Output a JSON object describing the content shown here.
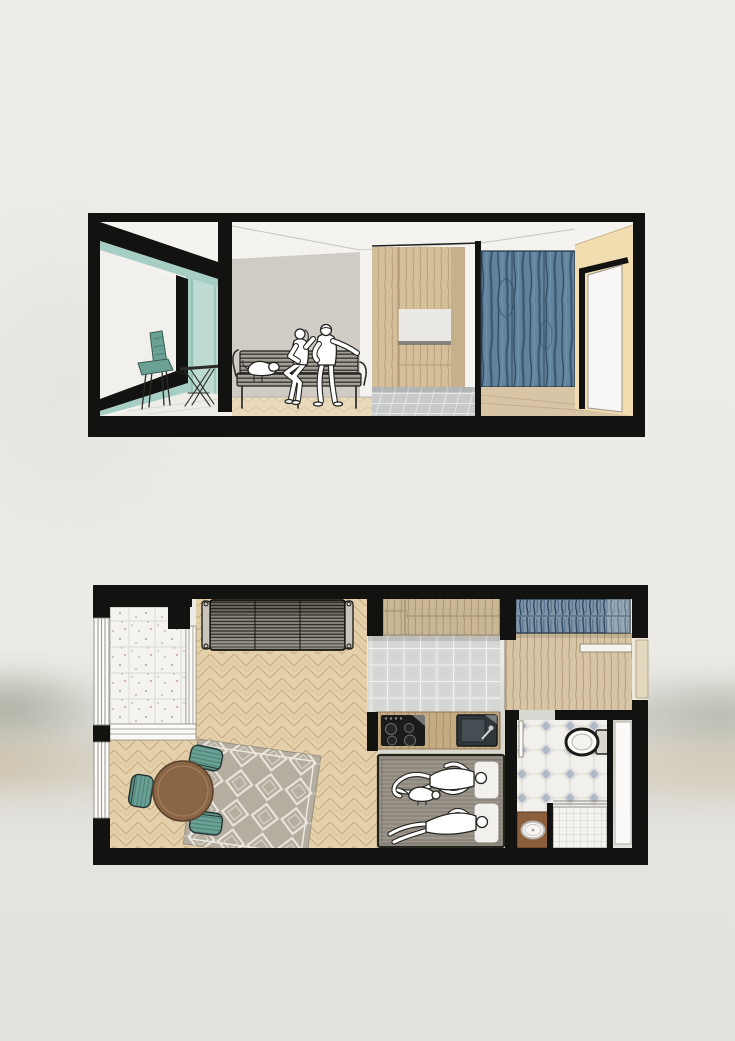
{
  "canvas": {
    "background": "#eceae6"
  },
  "palette": {
    "ink": "#121210",
    "paper": "#f4f3ef",
    "glass_teal": "#bedbd3",
    "glass_teal_deep": "#a6cec5",
    "wall_grey": "#d0ccc5",
    "wood_light": "#e9dabc",
    "wood_mid": "#d5bf9a",
    "backsplash": "#eae9e5",
    "tile_grey": "#c9cbcc",
    "wardrobe_blue": "#62829d",
    "wall_beige": "#f2ddb0",
    "door_white": "#f8f7f5",
    "plan_wood": "#e4d0ab",
    "terrazzo": "#f4f3ef",
    "rug_grey": "#b5ad9f",
    "table_brown": "#8a6546",
    "chair_teal": "#6ba195",
    "hall_wood": "#d8c5a6",
    "plan_tile": "#d9d9d7",
    "counter_wood": "#c5ab81",
    "bed_grey": "#9c958a",
    "pillow_white": "#f1f0ec",
    "bath_tile": "#efede9",
    "bath_diamond": "#a7b2c2",
    "shower_tile": "#f3f2ef",
    "basin_wood": "#8c5f3b",
    "fixture_white": "#f9f8f6",
    "people_stroke": "#23231f",
    "watercolor_green": "#a8aa9c",
    "watercolor_tan": "#cabfa8",
    "canvas_bg": "#eceae6"
  },
  "section_view": {
    "elements": [
      "balcony-glazing",
      "balcony-chair",
      "wire-base-table",
      "living-room-back-wall",
      "slatted-bench",
      "seated-woman",
      "seated-man",
      "lying-dog",
      "kitchen-cabinetry",
      "kitchen-backsplash",
      "kitchen-tile-floor",
      "blue-plywood-wardrobe",
      "beige-end-wall",
      "open-white-door",
      "parquet-floor"
    ]
  },
  "floor_plan": {
    "rooms": [
      "balcony",
      "living-room",
      "kitchen",
      "entry-hall",
      "wardrobe",
      "sleeping-nook",
      "bathroom"
    ],
    "furniture": [
      "striped-sofa",
      "diamond-pattern-rug",
      "round-dining-table",
      "teal-chair-north",
      "teal-chair-west",
      "teal-chair-south",
      "cooktop",
      "kitchen-sink",
      "double-bed",
      "person-lying-top",
      "person-lying-bottom",
      "dog-on-bed",
      "toilet",
      "washbasin",
      "shower",
      "entry-door",
      "bathroom-door"
    ]
  }
}
